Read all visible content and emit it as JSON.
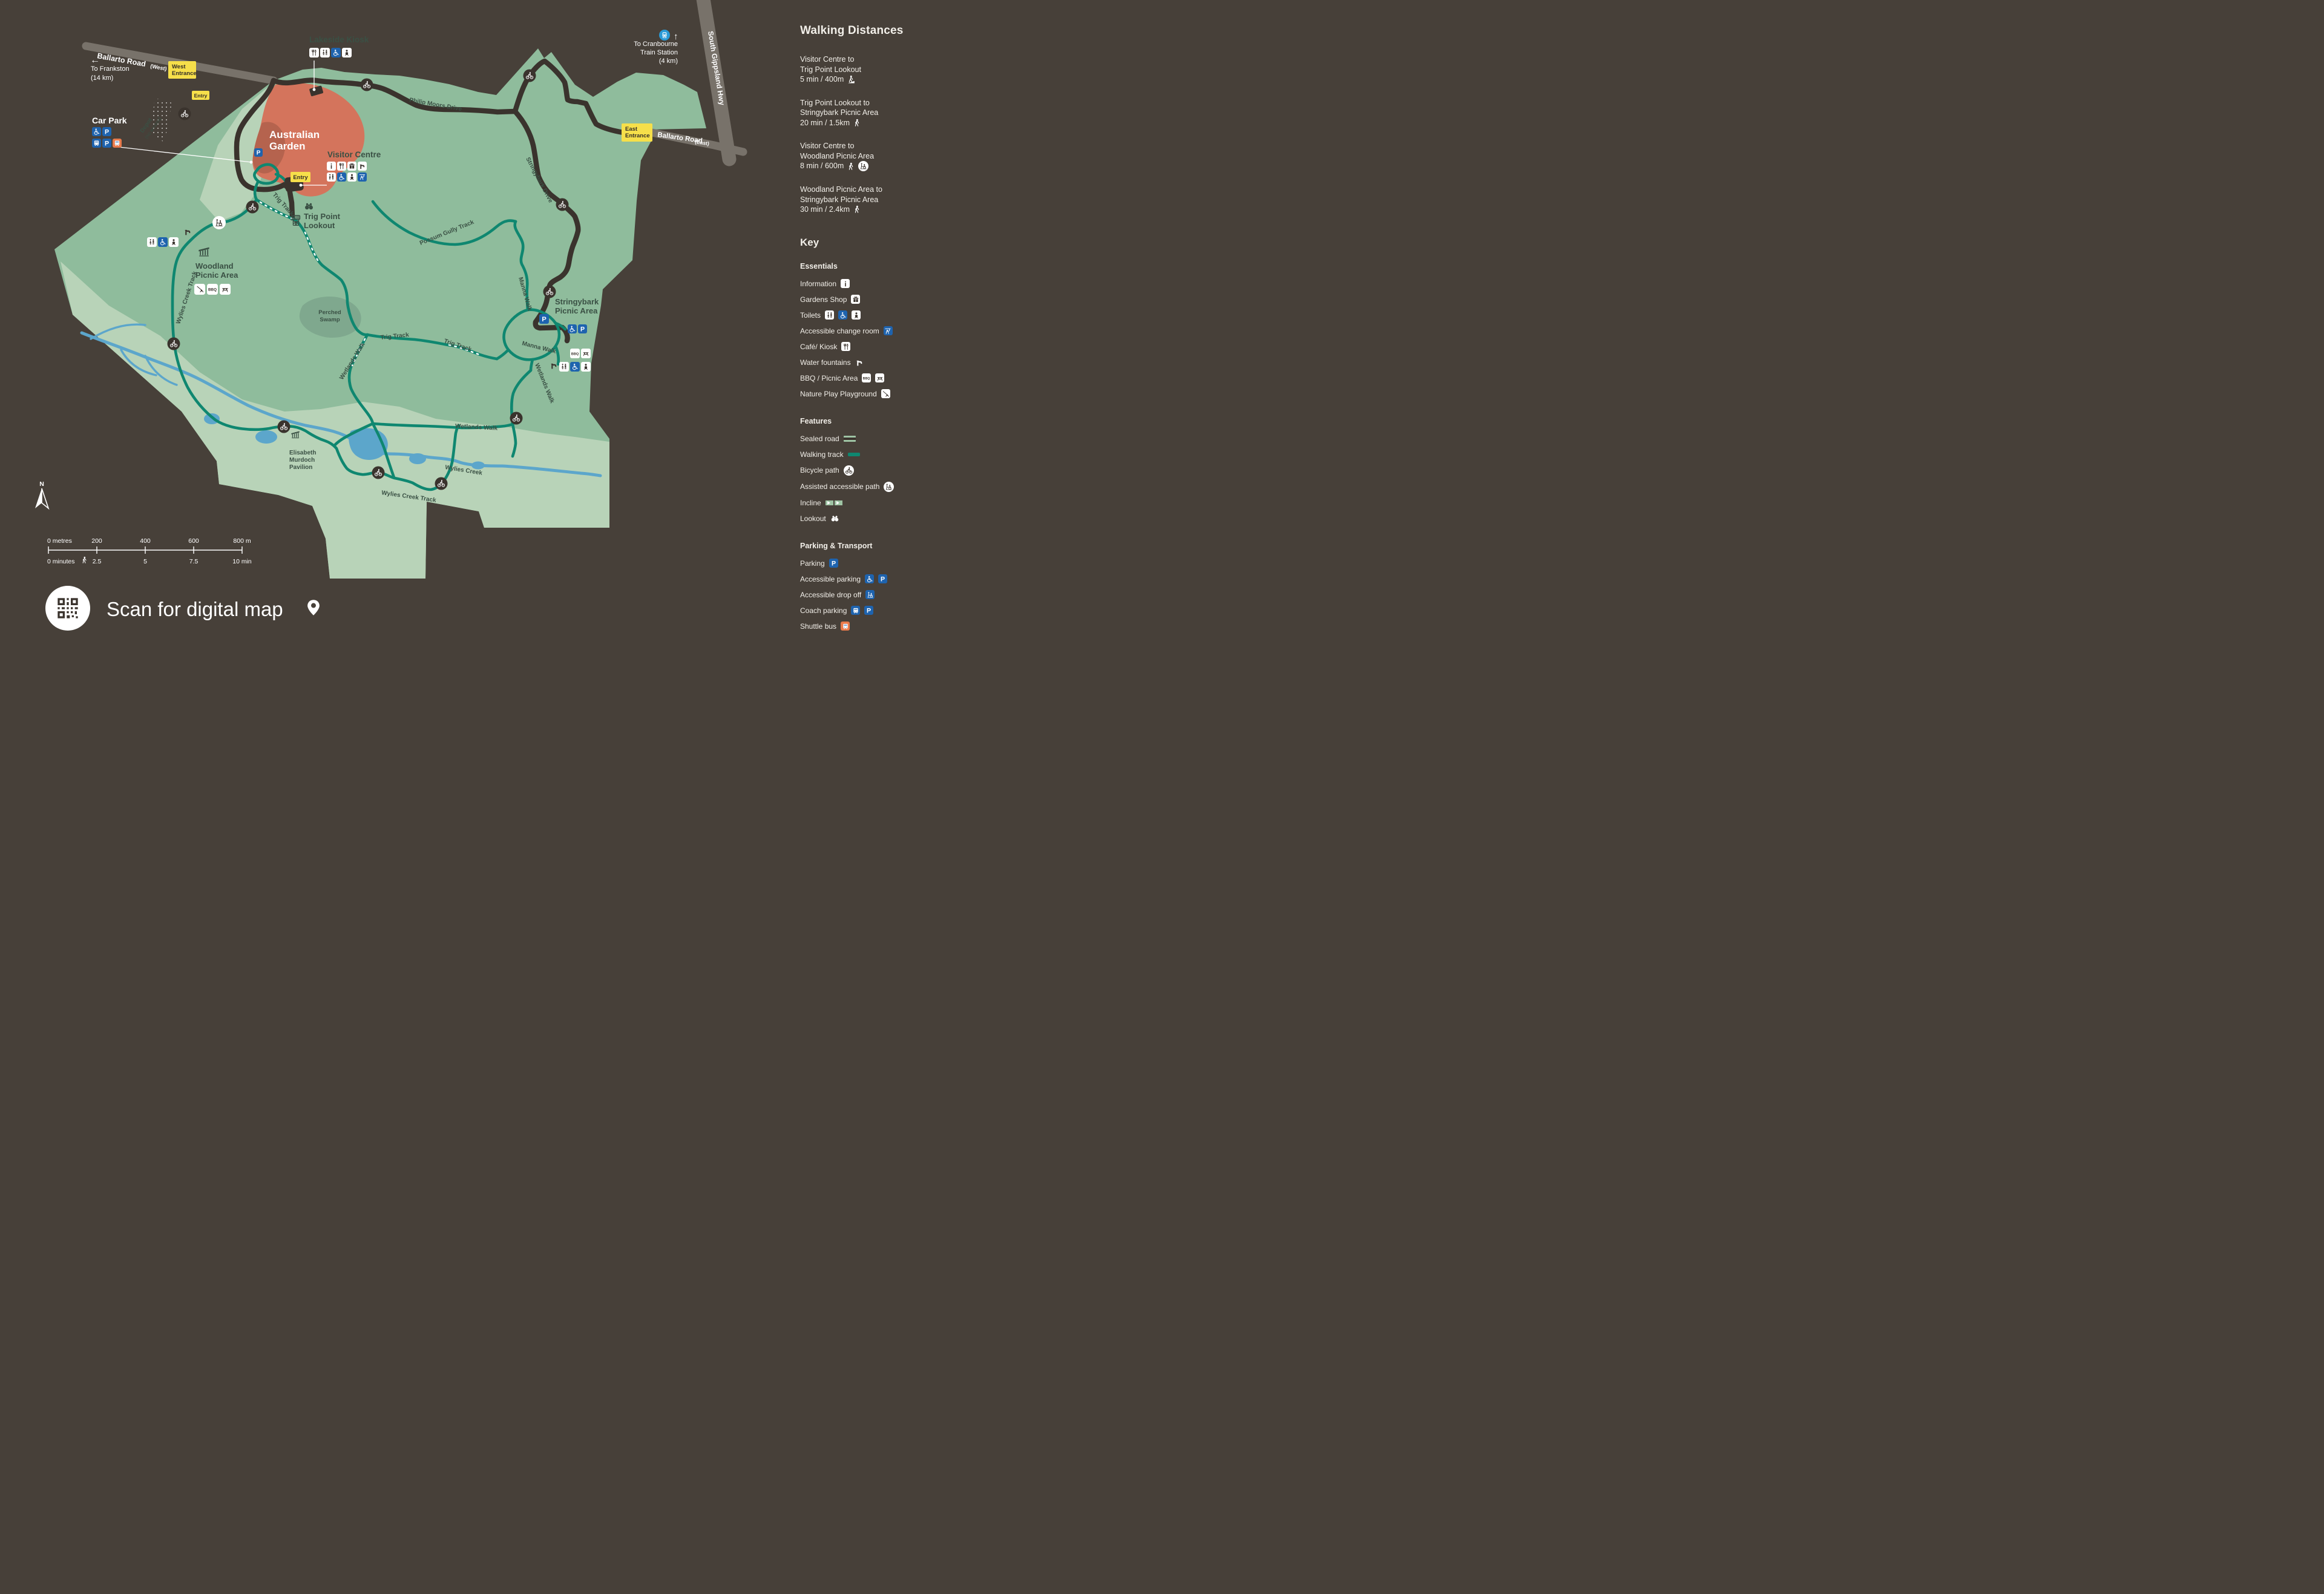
{
  "colors": {
    "background": "#474039",
    "map_green": "#8fbc9c",
    "map_light_green": "#b8d3b8",
    "swamp_green": "#7fa88e",
    "garden_red": "#d4745c",
    "garden_red_dark": "#b5634e",
    "road_dark": "#3a332d",
    "road_grey": "#78726a",
    "walking_track_teal": "#0f8770",
    "water_blue": "#5ca6cb",
    "label_yellow": "#f6df4a",
    "icon_blue": "#1e63ae",
    "train_blue": "#2a9ad6",
    "shuttle_orange": "#e87a4c",
    "map_text_green": "#3e5345",
    "panel_text": "#f2efe9"
  },
  "compass": {
    "north": "N"
  },
  "glyphs": {
    "p": "P",
    "bbq": "BBQ",
    "info": "i",
    "arrow_left": "←",
    "arrow_up": "↑"
  },
  "walking_distances": {
    "title": "Walking Distances",
    "items": [
      {
        "lines": [
          "Visitor Centre to",
          "Trig Point Lookout"
        ],
        "detail": "5 min / 400m",
        "icons": [
          "walker-incline"
        ]
      },
      {
        "lines": [
          "Trig Point Lookout to",
          "Stringybark Picnic Area"
        ],
        "detail": "20 min / 1.5km",
        "icons": [
          "walker"
        ]
      },
      {
        "lines": [
          "Visitor Centre to",
          "Woodland Picnic Area"
        ],
        "detail": "8 min / 600m",
        "icons": [
          "walker",
          "assisted"
        ]
      },
      {
        "lines": [
          "Woodland Picnic Area to",
          "Stringybark Picnic Area"
        ],
        "detail": "30 min / 2.4km",
        "icons": [
          "walker"
        ]
      }
    ]
  },
  "key": {
    "title": "Key",
    "sections": [
      {
        "heading": "Essentials",
        "items": [
          {
            "label": "Information"
          },
          {
            "label": "Gardens Shop"
          },
          {
            "label": "Toilets"
          },
          {
            "label": "Accessible change room"
          },
          {
            "label": "Café/ Kiosk"
          },
          {
            "label": "Water fountains"
          },
          {
            "label": "BBQ / Picnic Area"
          },
          {
            "label": "Nature Play Playground"
          }
        ]
      },
      {
        "heading": "Features",
        "items": [
          {
            "label": "Sealed road"
          },
          {
            "label": "Walking track"
          },
          {
            "label": "Bicycle path"
          },
          {
            "label": "Assisted accessible path"
          },
          {
            "label": "Incline"
          },
          {
            "label": "Lookout"
          }
        ]
      },
      {
        "heading": "Parking & Transport",
        "items": [
          {
            "label": "Parking"
          },
          {
            "label": "Accessible parking"
          },
          {
            "label": "Accessible drop off"
          },
          {
            "label": "Coach parking"
          },
          {
            "label": "Shuttle bus"
          }
        ]
      }
    ]
  },
  "map": {
    "labels": {
      "ballarto_west": "Ballarto Road",
      "ballarto_west_suffix": "(West)",
      "ballarto_east": "Ballarto Road",
      "ballarto_east_suffix": "(East)",
      "south_gippsland_hwy": "South Gippsland Hwy",
      "to_frankston_line1": "To Frankston",
      "to_frankston_line2": "(14 km)",
      "to_cranbourne_line1": "To Cranbourne",
      "to_cranbourne_line2": "Train Station",
      "to_cranbourne_line3": "(4 km)",
      "west_entrance_line1": "West",
      "west_entrance_line2": "Entrance",
      "east_entrance_line1": "East",
      "east_entrance_line2": "Entrance",
      "entry": "Entry",
      "car_park": "Car Park",
      "depot_line1": "Depot",
      "depot_line2": "(no access)",
      "australian_garden_line1": "Australian",
      "australian_garden_line2": "Garden",
      "lakeside_kiosk": "Lakeside Kiosk",
      "visitor_centre": "Visitor Centre",
      "philip_moors_drive": "Philip Moors Drive",
      "stringybark_drive": "Stringybark Drive",
      "trig_point_line1": "Trig Point",
      "trig_point_line2": "Lookout",
      "trig_track": "Trig Track",
      "possum_gully_track": "Possum Gully Track",
      "stringybark_picnic_line1": "Stringybark",
      "stringybark_picnic_line2": "Picnic Area",
      "manna_walk": "Manna Walk",
      "wetlands_walk": "Wetlands Walk",
      "woodland_picnic_line1": "Woodland",
      "woodland_picnic_line2": "Picnic Area",
      "wylies_creek_track": "Wylies Creek Track",
      "wylies_creek": "Wylies Creek",
      "perched_swamp_line1": "Perched",
      "perched_swamp_line2": "Swamp",
      "elisabeth_line1": "Elisabeth",
      "elisabeth_line2": "Murdoch",
      "elisabeth_line3": "Pavilion"
    }
  },
  "scale": {
    "metres": [
      "0 metres",
      "200",
      "400",
      "600",
      "800 m"
    ],
    "minutes": [
      "0 minutes",
      "2.5",
      "5",
      "7.5",
      "10 min"
    ]
  },
  "footer": {
    "scan_text": "Scan for digital map"
  }
}
